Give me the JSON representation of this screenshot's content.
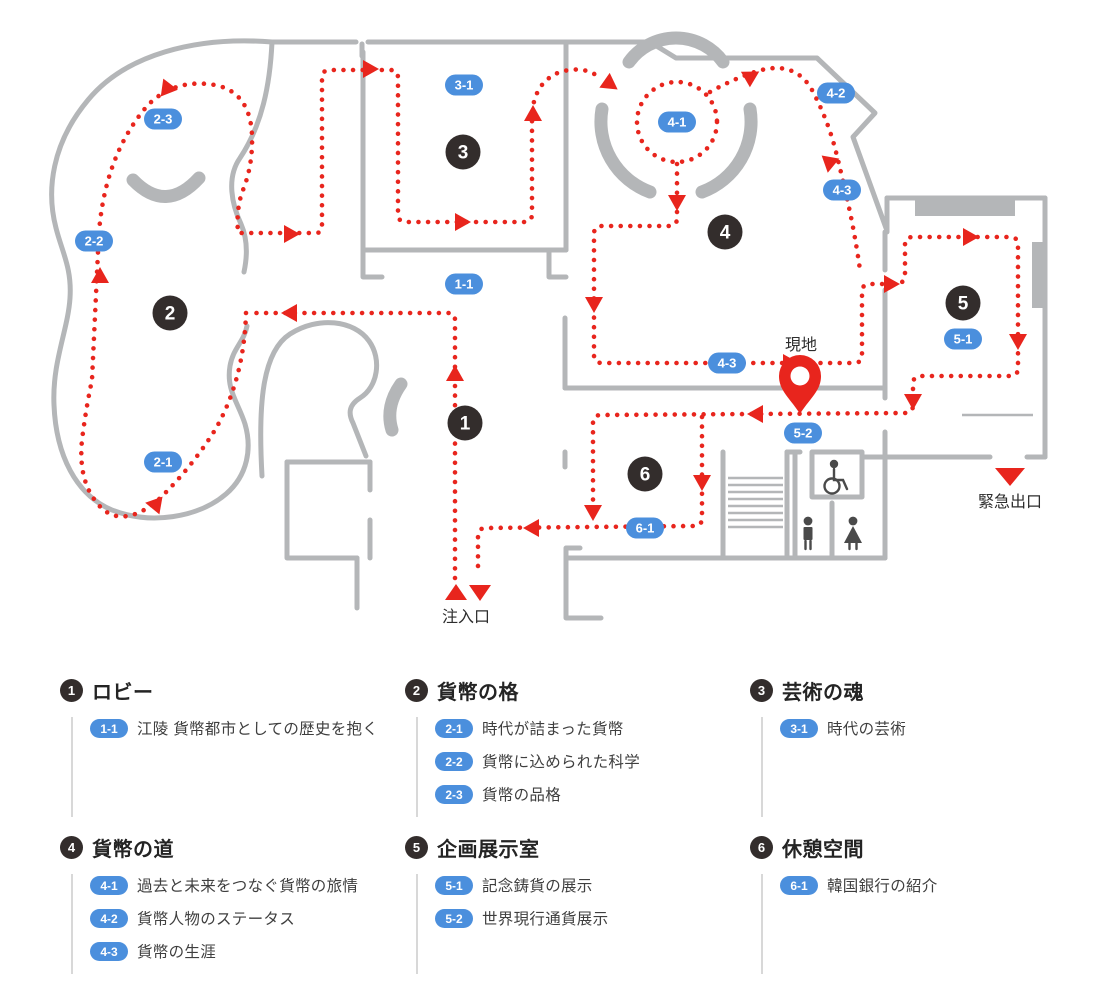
{
  "map": {
    "labels": {
      "current_location": "現地",
      "emergency_exit": "緊急出口",
      "entrance": "注入口"
    },
    "colors": {
      "route": "#e8251d",
      "badge_blue": "#4b8fdd",
      "wall_gray": "#b4b6b8",
      "zone_circle": "#332d2c"
    },
    "zone_markers": [
      {
        "id": "1",
        "x": 465,
        "y": 423
      },
      {
        "id": "2",
        "x": 170,
        "y": 313
      },
      {
        "id": "3",
        "x": 463,
        "y": 152
      },
      {
        "id": "4",
        "x": 725,
        "y": 232
      },
      {
        "id": "5",
        "x": 963,
        "y": 303
      },
      {
        "id": "6",
        "x": 645,
        "y": 474
      }
    ],
    "sub_markers": [
      {
        "id": "2-3",
        "x": 163,
        "y": 119
      },
      {
        "id": "2-2",
        "x": 94,
        "y": 241
      },
      {
        "id": "2-1",
        "x": 163,
        "y": 462
      },
      {
        "id": "3-1",
        "x": 464,
        "y": 85
      },
      {
        "id": "1-1",
        "x": 464,
        "y": 284
      },
      {
        "id": "4-1",
        "x": 677,
        "y": 122
      },
      {
        "id": "4-2",
        "x": 836,
        "y": 93
      },
      {
        "id": "4-3",
        "x": 842,
        "y": 190
      },
      {
        "id": "4-3",
        "x": 727,
        "y": 363
      },
      {
        "id": "5-1",
        "x": 963,
        "y": 339
      },
      {
        "id": "5-2",
        "x": 803,
        "y": 433
      },
      {
        "id": "6-1",
        "x": 645,
        "y": 528
      }
    ]
  },
  "legend": {
    "sections": [
      {
        "number": "1",
        "title": "ロビー",
        "items": [
          {
            "id": "1-1",
            "text": "江陵 貨幣都市としての歴史を抱く"
          }
        ]
      },
      {
        "number": "2",
        "title": "貨幣の格",
        "items": [
          {
            "id": "2-1",
            "text": "時代が詰まった貨幣"
          },
          {
            "id": "2-2",
            "text": "貨幣に込められた科学"
          },
          {
            "id": "2-3",
            "text": "貨幣の品格"
          }
        ]
      },
      {
        "number": "3",
        "title": "芸術の魂",
        "items": [
          {
            "id": "3-1",
            "text": "時代の芸術"
          }
        ]
      },
      {
        "number": "4",
        "title": "貨幣の道",
        "items": [
          {
            "id": "4-1",
            "text": "過去と未来をつなぐ貨幣の旅情"
          },
          {
            "id": "4-2",
            "text": "貨幣人物のステータス"
          },
          {
            "id": "4-3",
            "text": "貨幣の生涯"
          }
        ]
      },
      {
        "number": "5",
        "title": "企画展示室",
        "items": [
          {
            "id": "5-1",
            "text": "記念鋳貨の展示"
          },
          {
            "id": "5-2",
            "text": "世界現行通貨展示"
          }
        ]
      },
      {
        "number": "6",
        "title": "休憩空間",
        "items": [
          {
            "id": "6-1",
            "text": "韓国銀行の紹介"
          }
        ]
      }
    ]
  }
}
